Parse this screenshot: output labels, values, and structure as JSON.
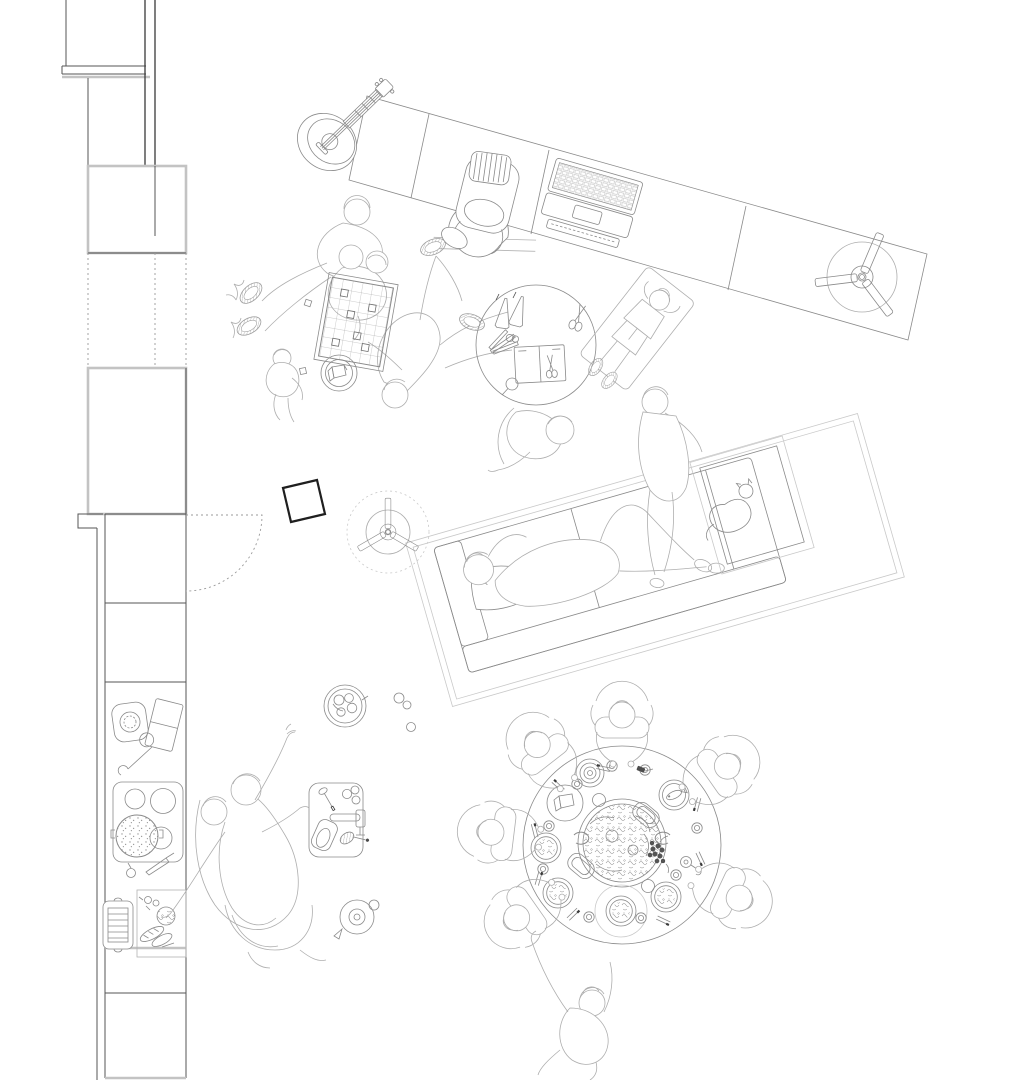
{
  "drawing": {
    "kind": "top-down architectural plan line drawing of a shared living space with people",
    "background": "#ffffff",
    "ink": {
      "wall_dark": "#3a3a3a",
      "wall_light": "#c3c3c3",
      "furniture": "#8f8f8f",
      "figures": "#aeaeae",
      "bold_accent": "#1f1f1f"
    },
    "labels": {
      "walls": "left wall with window openings and door swing",
      "kitchen_counter": "kitchen counter with kettle, cutting board, stove, baking tray and prep board",
      "kitchen_people": "two figures cooking at the counter",
      "desk": "long angled desk with guitar, backpack chair and laptop",
      "desk_fan": "three-blade ceiling fan over desk",
      "board_game": "group playing a grid board game on the floor with snack bowl and child",
      "craft_table": "round craft table with pencils, scissors, notebook and magnifier",
      "mat_person": "person lying on a mat",
      "sofa": "angled sofa on rug with person lying down and pillow",
      "armchair_cat": "armchair with sleeping cat",
      "stool": "bold tilted square stool",
      "room_fan": "three-blade ceiling fan in dashed circle",
      "snack_bowl": "bowl of snacks with loose fruit",
      "sink_panel": "counter panel with faucet, whisk, pitcher and eggs",
      "teapot": "teapot seen from above",
      "dining_table": "large round dining table with paella pan, plates, glasses and seven diners"
    }
  }
}
